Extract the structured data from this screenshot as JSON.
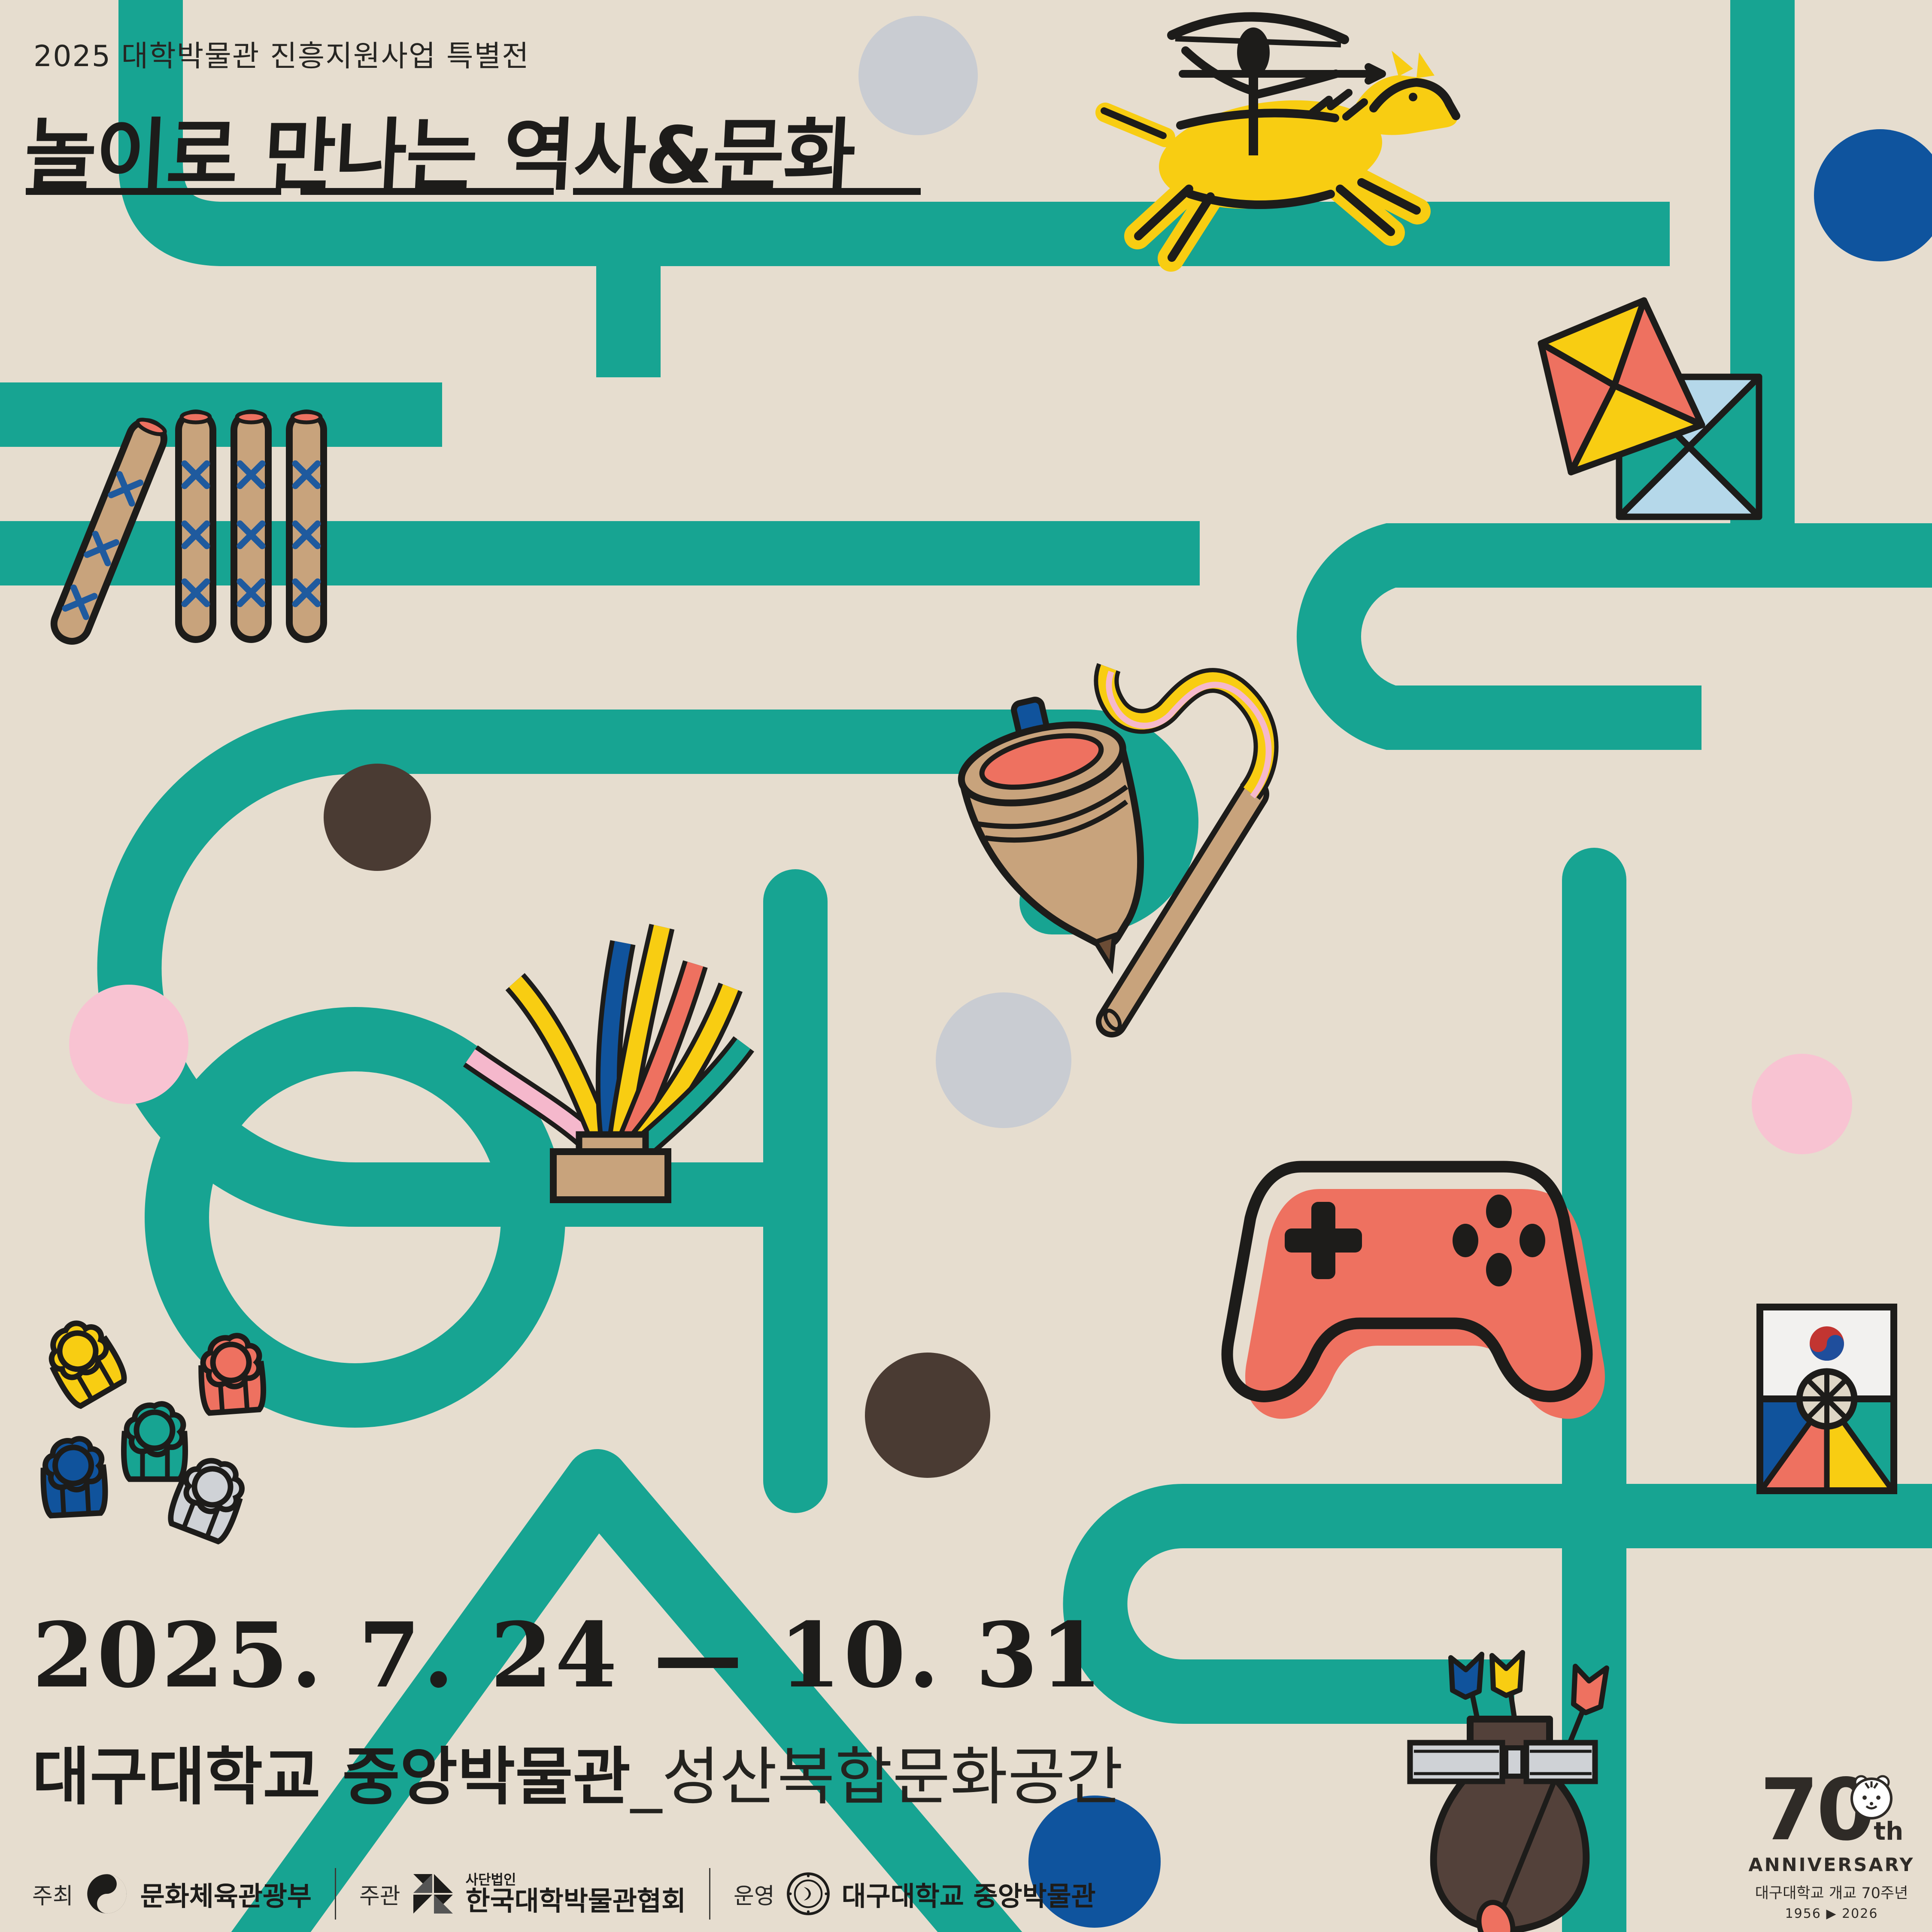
{
  "poster": {
    "eyebrow": "2025 대학박물관 진흥지원사업 특별전",
    "title": "놀이로 만나는 역사&문화",
    "date_range": "2025. 7. 24 — 10. 31",
    "venue": {
      "primary": "대구대학교 중앙박물관",
      "secondary": "_성산복합문화공간"
    },
    "credits": [
      {
        "role": "주최",
        "org": "문화체육관광부"
      },
      {
        "role": "주관",
        "org_prefix": "사단법인",
        "org": "한국대학박물관협회"
      },
      {
        "role": "운영",
        "org": "대구대학교 중앙박물관"
      }
    ],
    "anniversary": {
      "number": "70",
      "suffix": "th",
      "word": "ANNIVERSARY",
      "line1": "대구대학교 개교 70주년",
      "years": "1956 ▶ 2026"
    },
    "icons": [
      "horse-archer-icon",
      "kite-icon",
      "yut-sticks-icon",
      "spinning-top-icon",
      "jegi-icon",
      "gamepad-icon",
      "flower-pieces-icon",
      "ddakji-icon",
      "tuho-icon",
      "anniversary-tiger-icon",
      "taegeuk-logo-icon",
      "pinwheel-logo-icon",
      "university-seal-icon"
    ],
    "colors": {
      "background": "#e6ddcf",
      "teal": "#17a492",
      "yellow": "#f8cd12",
      "coral": "#ee7160",
      "blue": "#10539c",
      "pink": "#f5b8cc",
      "light_blue": "#b5d8ea",
      "tan": "#c8a37c",
      "brown": "#53413a",
      "silver": "#cfd2d6",
      "ink": "#1d1c1a"
    }
  }
}
